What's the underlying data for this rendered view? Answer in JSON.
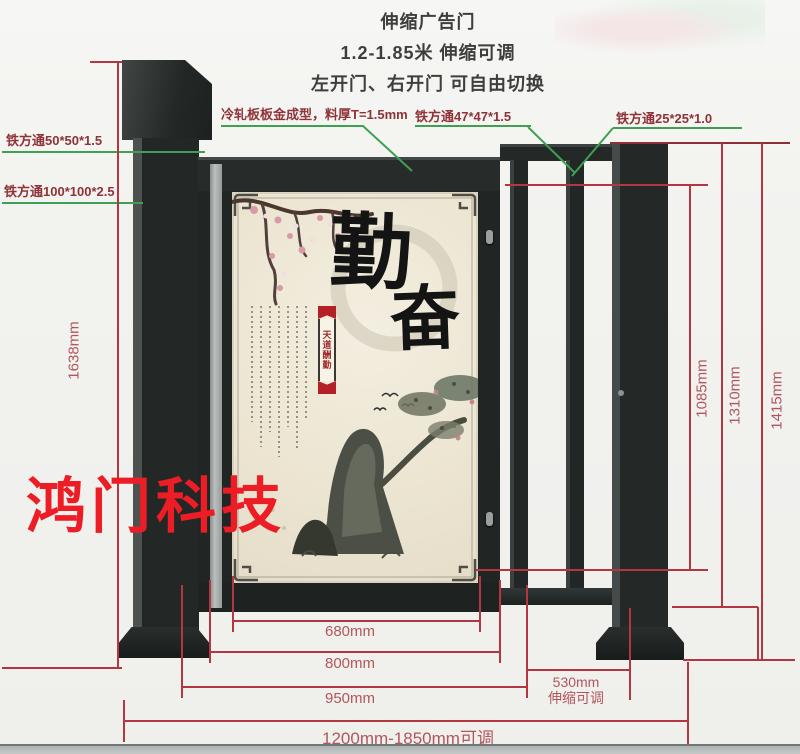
{
  "header": {
    "title": "伸缩广告门",
    "subtitle": "1.2-1.85米 伸缩可调",
    "note": "左开门、右开门 可自由切换"
  },
  "watermark": {
    "text": "鸿门科技",
    "color": "#ec1d24"
  },
  "part_labels": {
    "tube_50": "铁方通50*50*1.5",
    "tube_100": "铁方通100*100*2.5",
    "cold_rolled_plate": "冷轧板板金成型，料厚T=1.5mm",
    "tube_47": "铁方通47*47*1.5",
    "tube_25": "铁方通25*25*1.0"
  },
  "dimensions": {
    "left_height": "1638mm",
    "right_height_inner": "1085mm",
    "right_height_mid": "1310mm",
    "right_height_outer": "1415mm",
    "poster_width": "680mm",
    "door_width": "800mm",
    "door_outer_width": "950mm",
    "side_section_width": "530mm",
    "side_section_note": "伸缩可调",
    "total_width": "1200mm-1850mm可调"
  },
  "poster": {
    "calligraphy_char_1": "勤",
    "calligraphy_char_2": "奋",
    "seal_banner": "天道酬勤"
  },
  "colors": {
    "dimension_line": "#b13743",
    "leader_line": "#3f9f52",
    "part_label_text": "#8f3338",
    "dimension_text": "#b2565e",
    "gate_metal": "#242928",
    "poster_background": "#ece5d2",
    "watermark_red": "#ec1d24"
  }
}
